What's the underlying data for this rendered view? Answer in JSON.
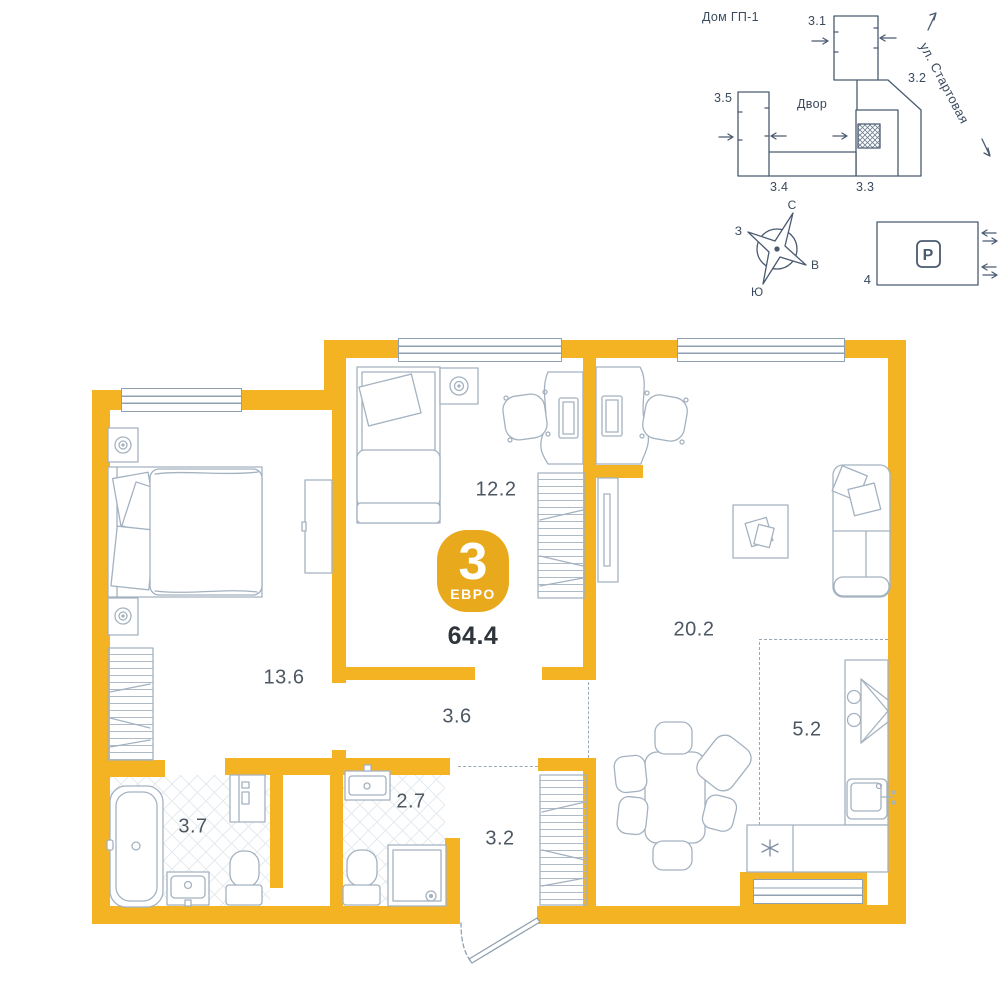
{
  "title_badge": {
    "rooms_count": "3",
    "type_label": "ЕВРО",
    "total_area": "64.4"
  },
  "room_labels": {
    "bedroom_main": "13.6",
    "bedroom_second": "12.2",
    "living": "20.2",
    "corridor": "3.6",
    "hall": "3.2",
    "bathroom_big": "3.7",
    "bathroom_small": "2.7",
    "kitchen_zone": "5.2"
  },
  "site_plan": {
    "house_label": "Дом ГП-1",
    "courtyard_label": "Двор",
    "street_label": "ул. Стартовая",
    "building_1": "3.1",
    "building_2": "3.2",
    "building_3": "3.3",
    "building_4": "3.4",
    "building_5": "3.5"
  },
  "compass": {
    "north": "С",
    "east": "В",
    "south": "Ю",
    "west": "З"
  },
  "parking": {
    "symbol": "P",
    "count": "4"
  },
  "colors": {
    "wall_yellow": "#F3B322",
    "badge_yellow": "#E8AA1C",
    "furniture_line": "#A4B2C0",
    "site_line": "#4A5A70",
    "label_text": "#4C5762",
    "area_text": "#30353B"
  }
}
